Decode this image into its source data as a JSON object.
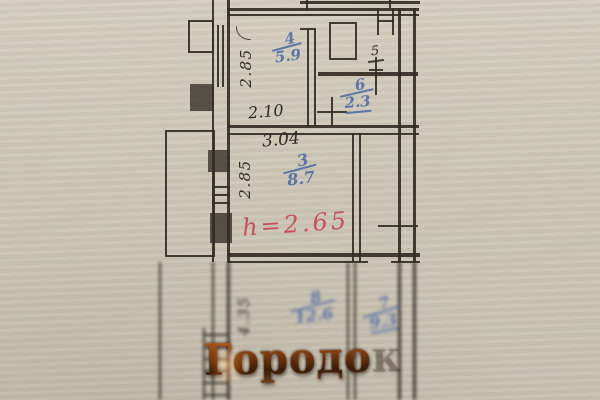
{
  "plan": {
    "dims": {
      "room4_height": "2.85",
      "room4_width": "2.10",
      "room3_width": "3.04",
      "room3_height": "2.85",
      "room8_height": "4.35"
    },
    "rooms": {
      "r4": {
        "number": "4",
        "area": "5.9"
      },
      "r5": {
        "number": "5"
      },
      "r6": {
        "number": "6",
        "area": "2.3"
      },
      "r3": {
        "number": "3",
        "area": "8.7"
      },
      "r8": {
        "number": "8",
        "area": "12.6"
      },
      "r7": {
        "number": "7",
        "area": "9.3"
      }
    },
    "notes": {
      "ceiling_height": "h=2.65"
    }
  },
  "watermark": {
    "text": "Городок"
  },
  "colors": {
    "paper": "#cdc6b6",
    "ink": "#2f2a21",
    "blue_ink": "#526ca4",
    "red_ink": "#c4404d",
    "watermark_orange": "#e0761f"
  }
}
